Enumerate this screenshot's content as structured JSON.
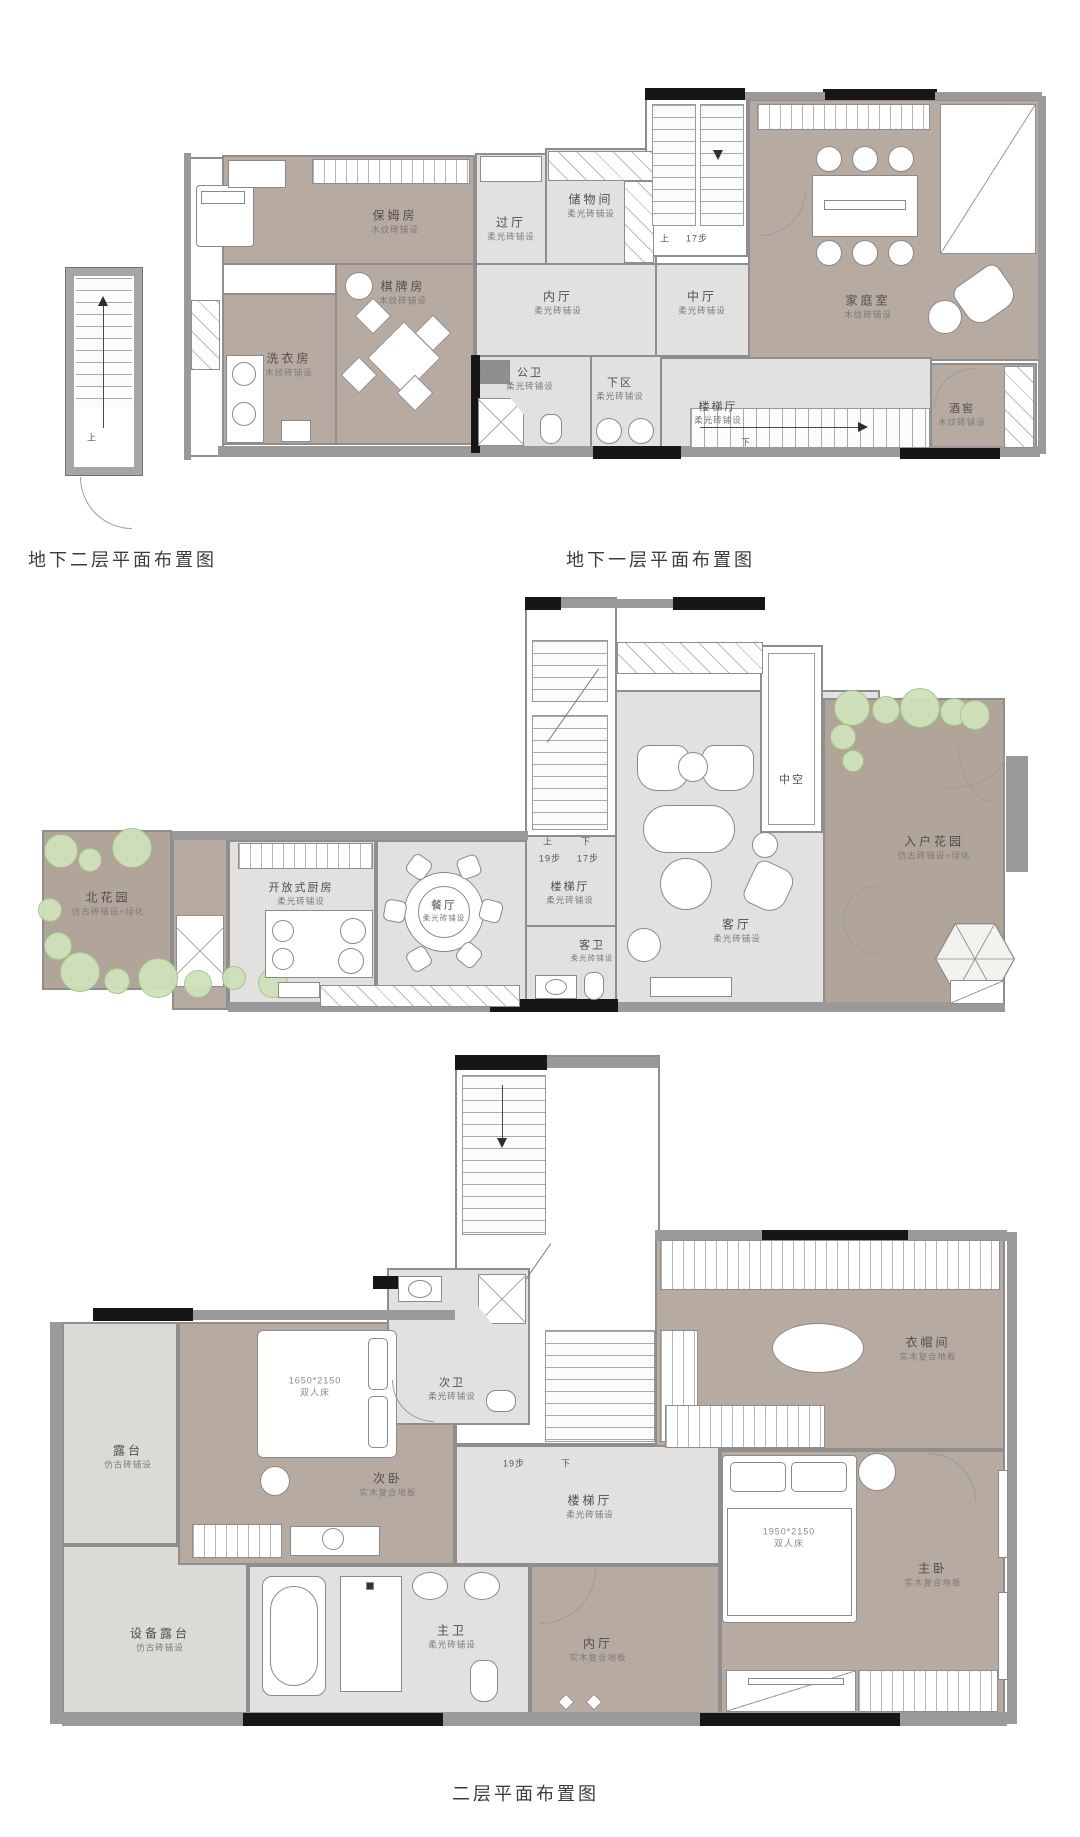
{
  "colors": {
    "taupe": "#b7aaa0",
    "light_tile": "#e2e1df",
    "garden": "#b1a499",
    "terrace": "#dcdad6",
    "wall": "#9a9a9a",
    "wall_dark": "#161616",
    "tree": "#cfe2ba"
  },
  "plans": {
    "b2": {
      "title": "地下二层平面布置图",
      "stair_up": "上"
    },
    "b1": {
      "title": "地下一层平面布置图",
      "stair_up": "上",
      "stair_up_steps": "17步",
      "stair_down": "下",
      "rooms": [
        {
          "name": "保姆房",
          "finish": "木纹砖铺设"
        },
        {
          "name": "过厅",
          "finish": "柔光砖铺设"
        },
        {
          "name": "储物间",
          "finish": "柔光砖铺设"
        },
        {
          "name": "棋牌房",
          "finish": "木纹砖铺设"
        },
        {
          "name": "洗衣房",
          "finish": "木纹砖铺设"
        },
        {
          "name": "内厅",
          "finish": "柔光砖铺设"
        },
        {
          "name": "中厅",
          "finish": "柔光砖铺设"
        },
        {
          "name": "家庭室",
          "finish": "木纹砖铺设"
        },
        {
          "name": "公卫",
          "finish": "柔光砖铺设"
        },
        {
          "name": "下区",
          "finish": "柔光砖铺设"
        },
        {
          "name": "楼梯厅",
          "finish": "柔光砖铺设"
        },
        {
          "name": "酒窖",
          "finish": "木纹砖铺设"
        }
      ]
    },
    "f1": {
      "title": "一层平面布置图",
      "stair_up": "上",
      "stair_up_steps": "19步",
      "stair_down": "下",
      "stair_down_steps": "17步",
      "rooms": [
        {
          "name": "北花园",
          "finish": "仿古砖铺设+绿化"
        },
        {
          "name": "开放式厨房",
          "finish": "柔光砖铺设"
        },
        {
          "name": "餐厅",
          "finish": "柔光砖铺设"
        },
        {
          "name": "楼梯厅",
          "finish": "柔光砖铺设"
        },
        {
          "name": "客卫",
          "finish": "柔光砖铺设"
        },
        {
          "name": "客厅",
          "finish": "柔光砖铺设"
        },
        {
          "name": "中空",
          "finish": ""
        },
        {
          "name": "入户花园",
          "finish": "仿古砖铺设+绿化"
        }
      ]
    },
    "f2": {
      "title": "二层平面布置图",
      "stair_steps": "19步",
      "stair_down": "下",
      "bed_secondary": {
        "size": "1650*2150",
        "label": "双人床"
      },
      "bed_master": {
        "size": "1950*2150",
        "label": "双人床"
      },
      "rooms": [
        {
          "name": "露台",
          "finish": "仿古砖铺设"
        },
        {
          "name": "次卧",
          "finish": "实木复合地板"
        },
        {
          "name": "次卫",
          "finish": "柔光砖铺设"
        },
        {
          "name": "楼梯厅",
          "finish": "柔光砖铺设"
        },
        {
          "name": "衣帽间",
          "finish": "实木复合地板"
        },
        {
          "name": "主卧",
          "finish": "实木复合地板"
        },
        {
          "name": "主卫",
          "finish": "柔光砖铺设"
        },
        {
          "name": "内厅",
          "finish": "实木复合地板"
        },
        {
          "name": "设备露台",
          "finish": "仿古砖铺设"
        }
      ]
    }
  }
}
